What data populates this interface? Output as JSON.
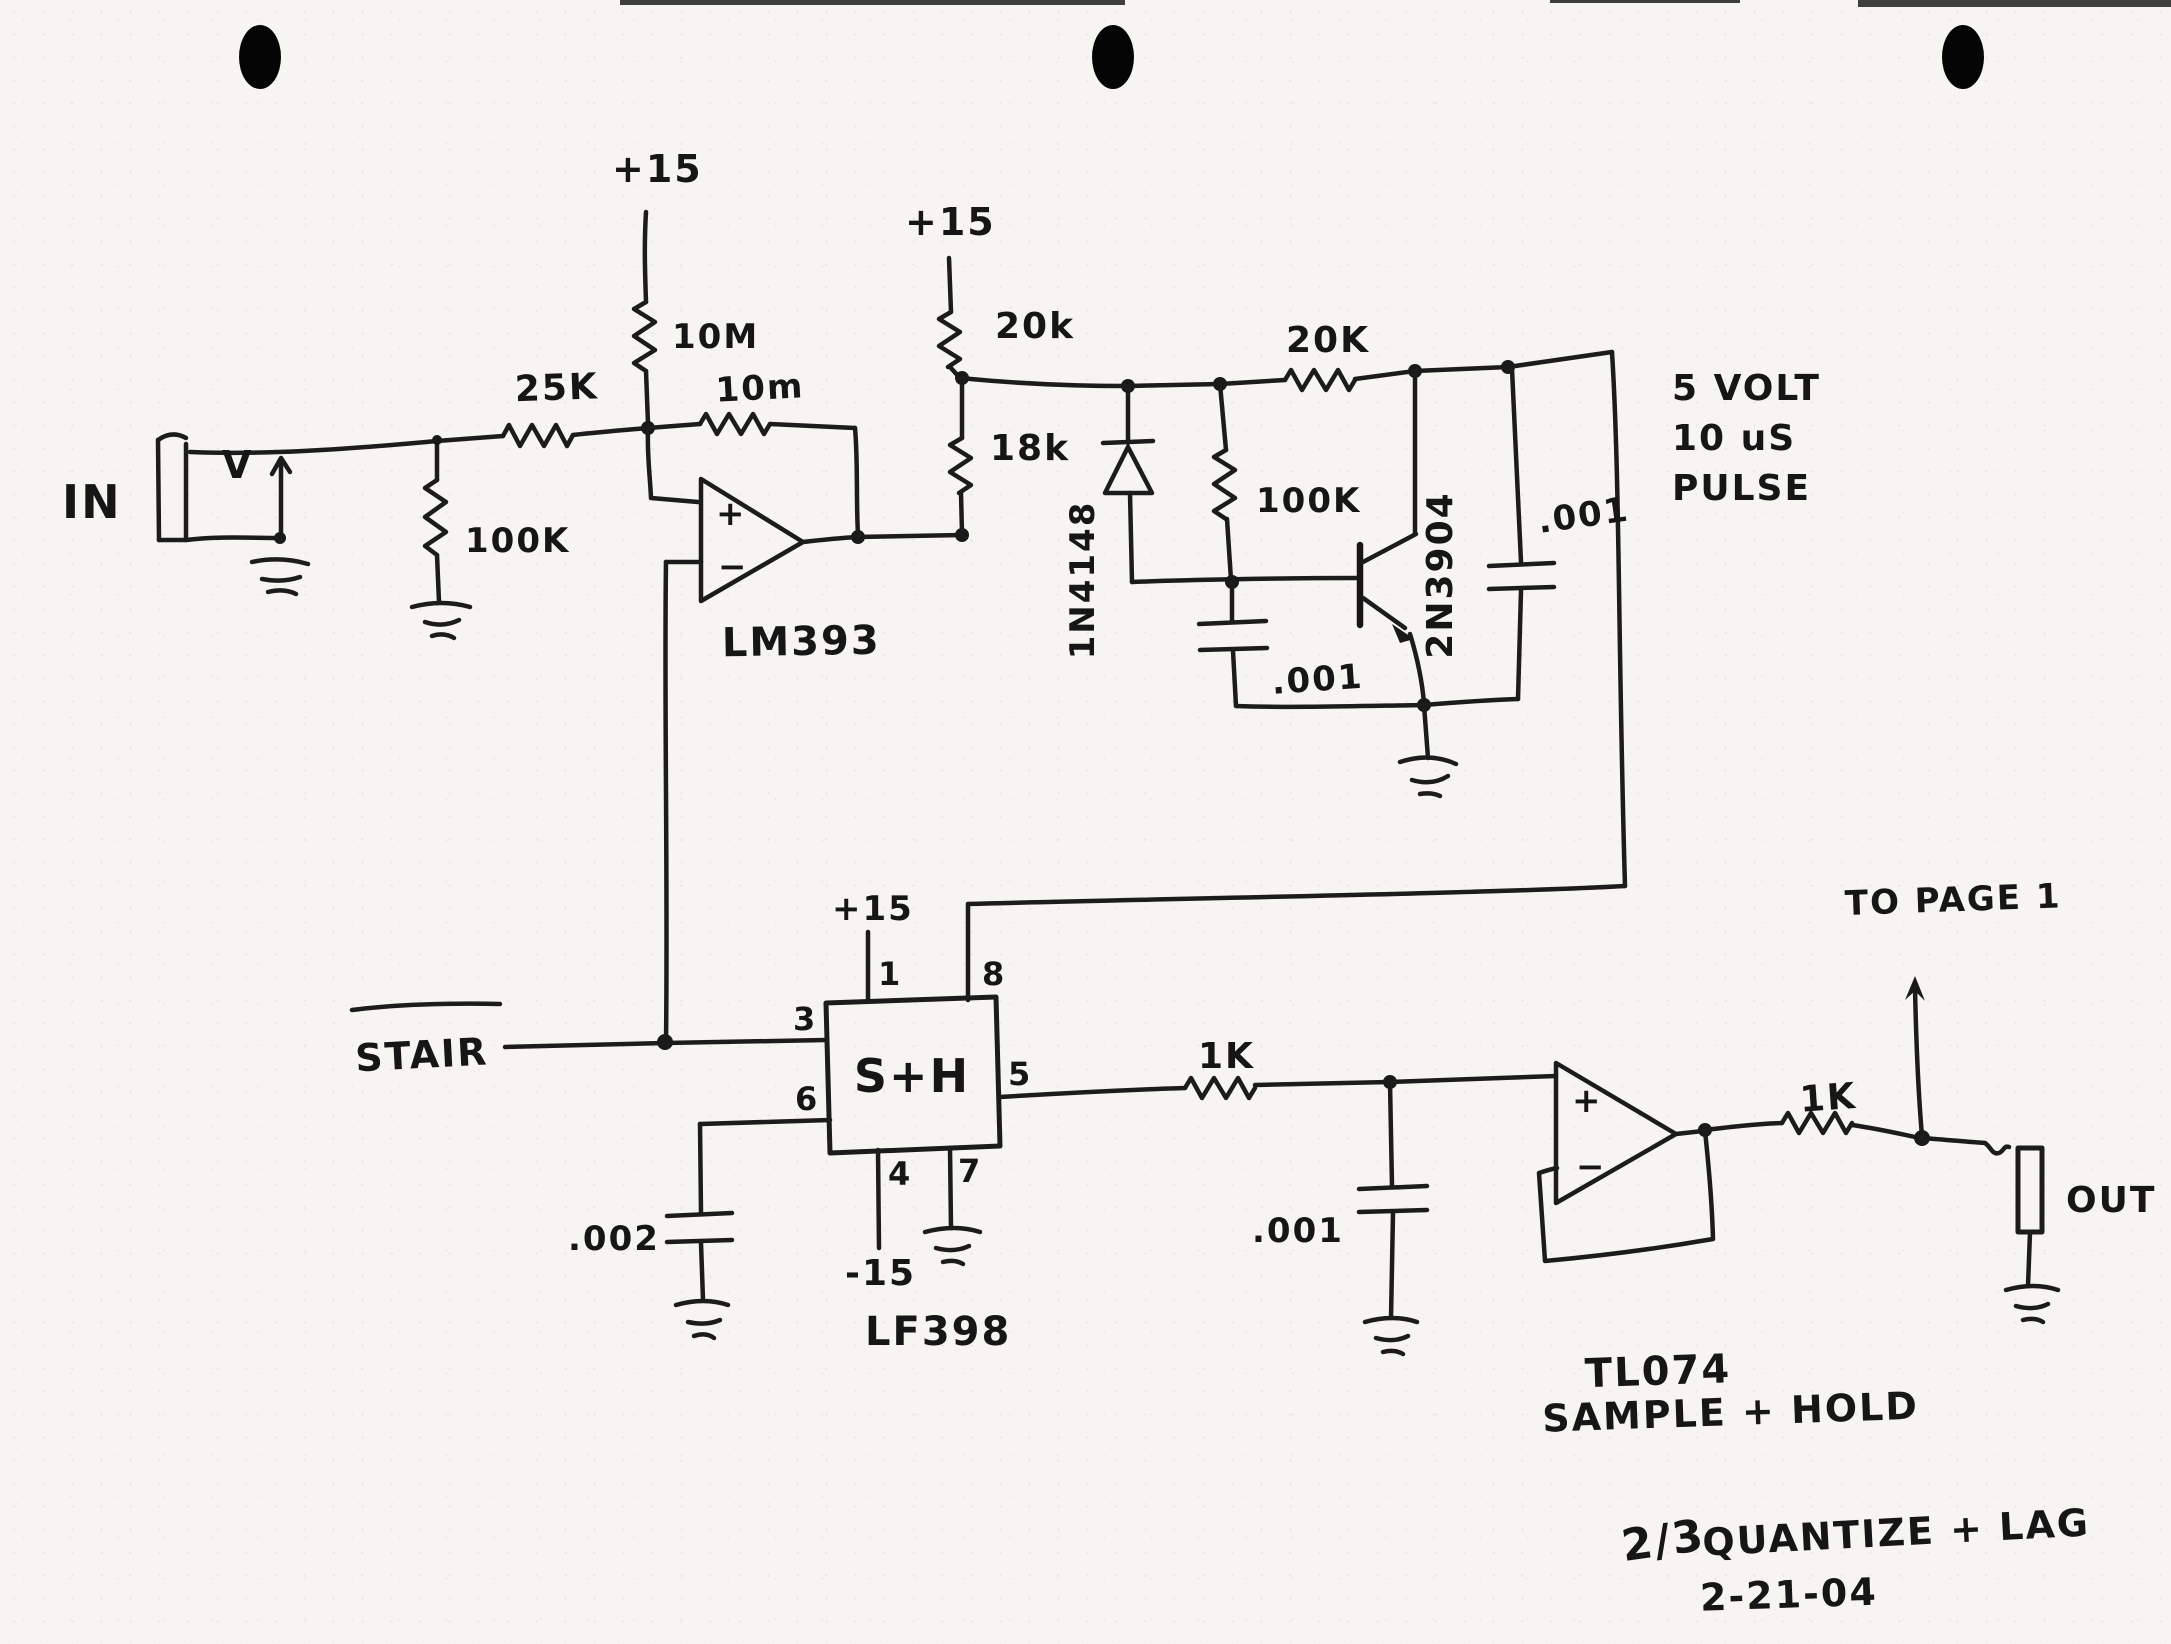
{
  "schematic": {
    "input": {
      "jack_label": "IN",
      "signal_mark": "V",
      "r_series": "25K",
      "r_load": "100K",
      "supply": "+15",
      "r_pullup": "10M",
      "r_feedback": "10m",
      "comparator": "LM393",
      "plus": "+",
      "minus": "−"
    },
    "pulse": {
      "supply": "+15",
      "r_top": "20k",
      "r_bottom": "18k",
      "diode": "1N4148",
      "r_base": "100K",
      "transistor": "2N3904",
      "c_base": ".001",
      "r_collector": "20K",
      "c_out": ".001",
      "note_line1": "5 VOLT",
      "note_line2": "10 uS",
      "note_line3": "PULSE"
    },
    "sh": {
      "stair": "STAIR",
      "block": "S+H",
      "chip": "LF398",
      "supply_pos": "+15",
      "supply_neg": "-15",
      "pin1": "1",
      "pin3": "3",
      "pin4": "4",
      "pin5": "5",
      "pin6": "6",
      "pin7": "7",
      "pin8": "8",
      "c_hold": ".002",
      "r_out": "1K",
      "c_filter": ".001",
      "opamp": "TL074",
      "plus": "+",
      "minus": "−",
      "r_final": "1K",
      "to_page": "TO PAGE 1",
      "out_label": "OUT"
    },
    "notes": {
      "function": "SAMPLE + HOLD",
      "page_fraction": "2/3",
      "title": "QUANTIZE + LAG",
      "date": "2-21-04"
    }
  }
}
